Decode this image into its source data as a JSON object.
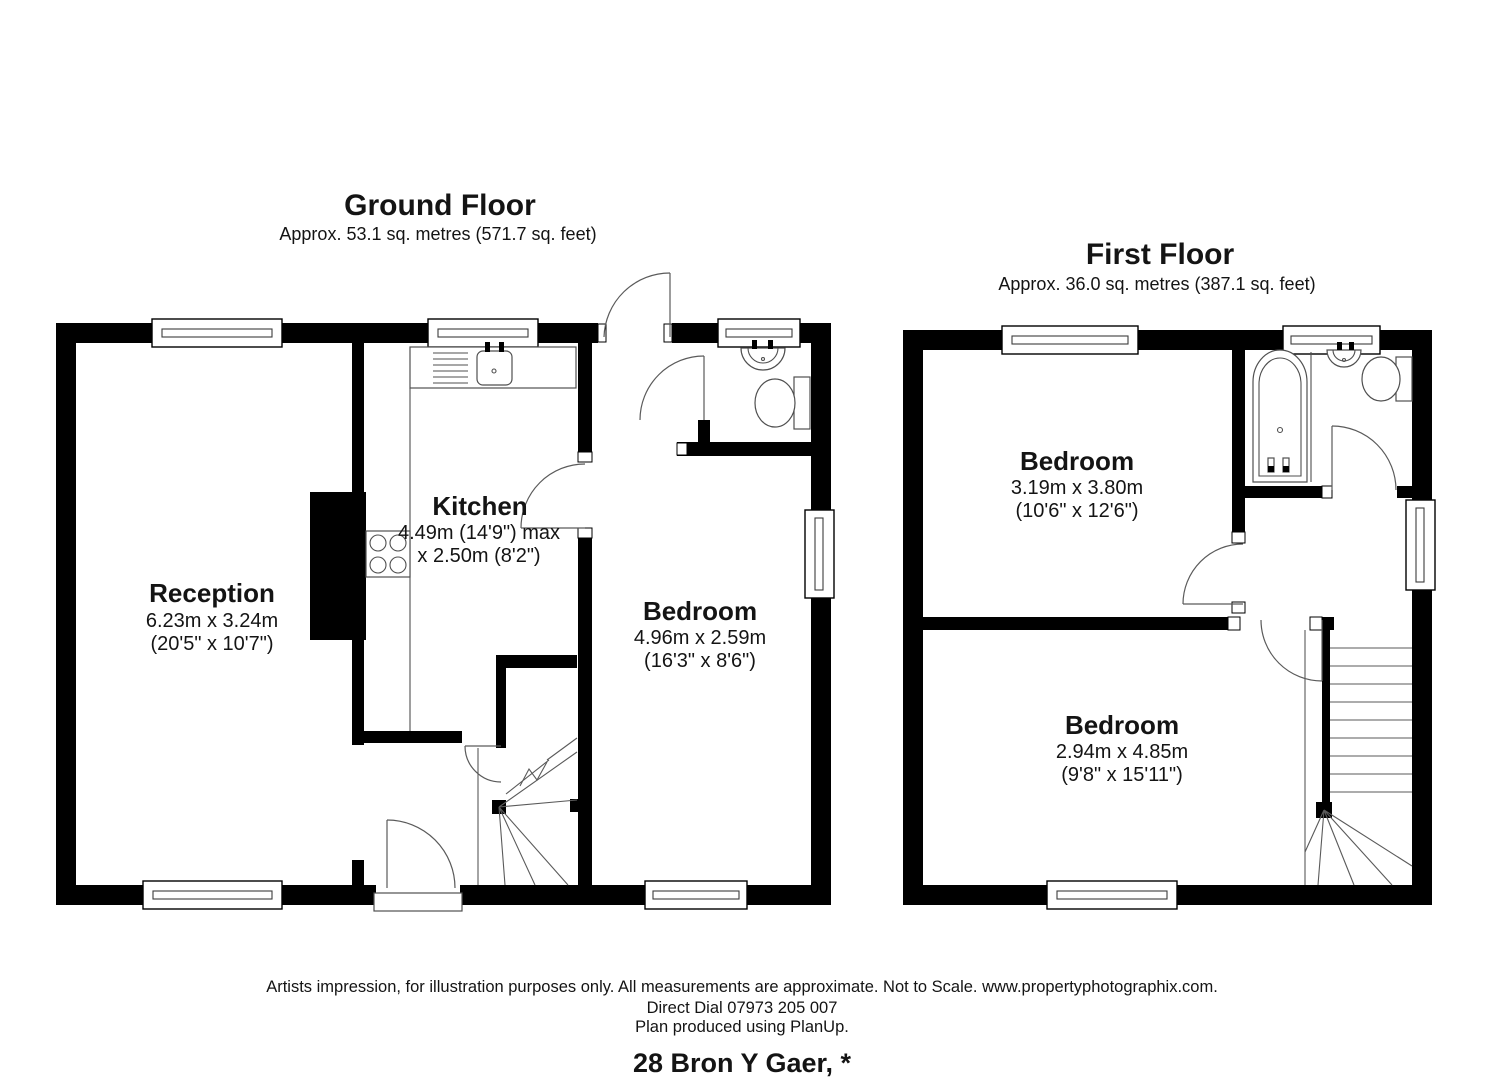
{
  "ground_floor": {
    "title": "Ground Floor",
    "area": "Approx. 53.1 sq. metres (571.7 sq. feet)",
    "reception": {
      "label": "Reception",
      "line1": "6.23m x 3.24m",
      "line2": "(20'5\" x 10'7\")"
    },
    "kitchen": {
      "label": "Kitchen",
      "line1": "4.49m (14'9\") max",
      "line2": "x 2.50m (8'2\")"
    },
    "bedroom": {
      "label": "Bedroom",
      "line1": "4.96m x 2.59m",
      "line2": "(16'3\" x 8'6\")"
    }
  },
  "first_floor": {
    "title": "First Floor",
    "area": "Approx. 36.0 sq. metres (387.1 sq. feet)",
    "bedroom1": {
      "label": "Bedroom",
      "line1": "3.19m x 3.80m",
      "line2": "(10'6\" x 12'6\")"
    },
    "bedroom2": {
      "label": "Bedroom",
      "line1": "2.94m x 4.85m",
      "line2": "(9'8\" x 15'11\")"
    }
  },
  "footer": {
    "disclaimer": "Artists impression, for illustration purposes only. All measurements are approximate. Not to Scale. www.propertyphotographix.com.",
    "phone": "Direct Dial 07973 205 007",
    "produced": "Plan produced using PlanUp.",
    "address": "28 Bron Y Gaer, *"
  },
  "colors": {
    "wall": "#000000",
    "thin_line": "#5a5a5a",
    "background": "#ffffff"
  }
}
